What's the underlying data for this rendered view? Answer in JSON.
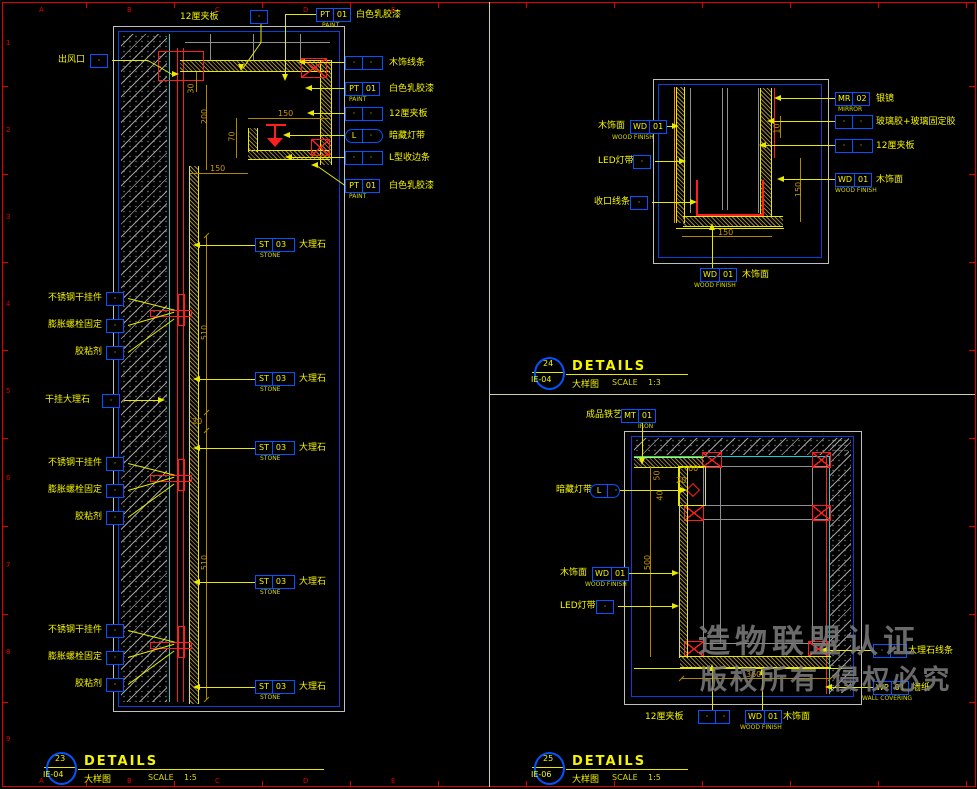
{
  "frame": {
    "zone_letters": [
      "A",
      "B",
      "C",
      "D",
      "E"
    ],
    "row_numbers": [
      "1",
      "2",
      "3",
      "4",
      "5",
      "6",
      "7",
      "8",
      "9"
    ]
  },
  "watermark": {
    "line1": "造物联盟认证",
    "line2": "版权所有  侵权必究"
  },
  "title_blocks": [
    {
      "number": "23",
      "sheet": "IE-04",
      "title": "DETAILS",
      "name": "大样图",
      "scale_label": "SCALE",
      "scale": "1:5"
    },
    {
      "number": "24",
      "sheet": "IE-04",
      "title": "DETAILS",
      "name": "大样图",
      "scale_label": "SCALE",
      "scale": "1:3"
    },
    {
      "number": "25",
      "sheet": "IE-06",
      "title": "DETAILS",
      "name": "大样图",
      "scale_label": "SCALE",
      "scale": "1:5"
    }
  ],
  "left_detail": {
    "top_callouts": [
      {
        "label": "12厘夹板",
        "c": [
          "·"
        ]
      },
      {
        "c": [
          "PT",
          "01"
        ],
        "sub": "PAINT",
        "label": "白色乳胶漆"
      }
    ],
    "left_callouts": [
      {
        "label": "出风口"
      },
      {
        "label": "不锈钢干挂件"
      },
      {
        "label": "膨胀螺栓固定"
      },
      {
        "label": "胶粘剂"
      },
      {
        "label": "干挂大理石"
      },
      {
        "label": "不锈钢干挂件"
      },
      {
        "label": "膨胀螺栓固定"
      },
      {
        "label": "胶粘剂"
      },
      {
        "label": "不锈钢干挂件"
      },
      {
        "label": "膨胀螺栓固定"
      },
      {
        "label": "胶粘剂"
      }
    ],
    "right_callouts": [
      {
        "c": [
          "·",
          "·"
        ],
        "label": "木饰线条"
      },
      {
        "c": [
          "PT",
          "01"
        ],
        "sub": "PAINT",
        "label": "白色乳胶漆"
      },
      {
        "c": [
          "·",
          "·"
        ],
        "label": "12厘夹板"
      },
      {
        "c": [
          "L",
          "·"
        ],
        "label": "暗藏灯带"
      },
      {
        "c": [
          "·",
          "·"
        ],
        "label": "L型收边条"
      },
      {
        "c": [
          "PT",
          "01"
        ],
        "sub": "PAINT",
        "label": "白色乳胶漆"
      },
      {
        "c": [
          "ST",
          "03"
        ],
        "sub": "STONE",
        "label": "大理石"
      },
      {
        "c": [
          "ST",
          "03"
        ],
        "sub": "STONE",
        "label": "大理石"
      },
      {
        "c": [
          "ST",
          "03"
        ],
        "sub": "STONE",
        "label": "大理石"
      },
      {
        "c": [
          "ST",
          "03"
        ],
        "sub": "STONE",
        "label": "大理石"
      },
      {
        "c": [
          "ST",
          "03"
        ],
        "sub": "STONE",
        "label": "大理石"
      }
    ],
    "dims": [
      "30",
      "200",
      "70",
      "150",
      "150",
      "510",
      "20",
      "510"
    ]
  },
  "top_right_detail": {
    "left_callouts": [
      {
        "label": "木饰面",
        "c": [
          "WD",
          "01"
        ],
        "sub": "WOOD FINISH"
      },
      {
        "label": "LED灯带",
        "c": [
          "·"
        ]
      },
      {
        "label": "收口线条",
        "c": [
          "·"
        ]
      }
    ],
    "right_callouts": [
      {
        "c": [
          "MR",
          "02"
        ],
        "sub": "MIRROR",
        "label": "银镜"
      },
      {
        "c": [
          "·",
          "·"
        ],
        "label": "玻璃胶+玻璃固定胶"
      },
      {
        "c": [
          "·",
          "·"
        ],
        "label": "12厘夹板"
      },
      {
        "c": [
          "WD",
          "01"
        ],
        "sub": "WOOD FINISH",
        "label": "木饰面"
      }
    ],
    "bottom_callout": {
      "c": [
        "WD",
        "01"
      ],
      "sub": "WOOD FINISH",
      "label": "木饰面"
    },
    "dims": [
      "10",
      "150",
      "150"
    ]
  },
  "bottom_right_detail": {
    "top_callout": {
      "label": "成品铁艺",
      "c": [
        "MT",
        "01"
      ],
      "sub": "IRON"
    },
    "left_callouts": [
      {
        "label": "暗藏灯带",
        "c": [
          "L",
          "·"
        ]
      },
      {
        "label": "木饰面",
        "c": [
          "WD",
          "01"
        ],
        "sub": "WOOD FINISH"
      },
      {
        "label": "LED灯带",
        "c": [
          "·"
        ]
      }
    ],
    "right_callouts": [
      {
        "c": [
          "·",
          "·"
        ],
        "label": "大理石线条"
      },
      {
        "c": [
          "WP",
          "01"
        ],
        "sub": "WALL COVERING",
        "label": "墙纸"
      }
    ],
    "bottom_callouts": [
      {
        "label": "12厘夹板",
        "c": [
          "·",
          "·"
        ]
      },
      {
        "c": [
          "WD",
          "01"
        ],
        "sub": "WOOD FINISH",
        "label": "木饰面"
      }
    ],
    "dims": [
      "50",
      "60",
      "20",
      "40",
      "500",
      "360"
    ]
  }
}
